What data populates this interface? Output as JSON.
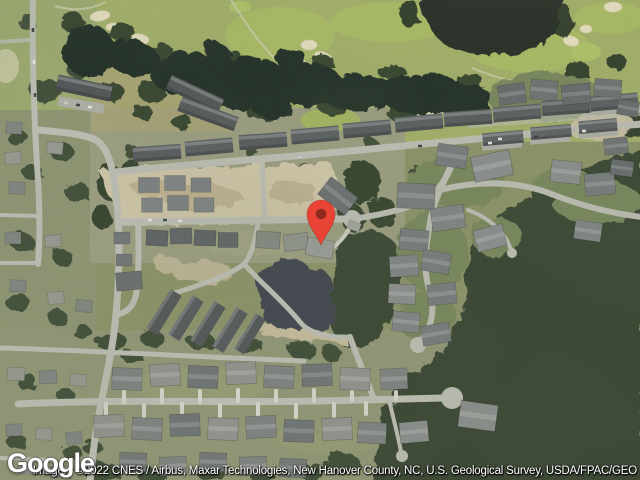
{
  "branding": {
    "logo_text": "Google"
  },
  "attribution": {
    "text": "Imagery ©2022 CNES / Airbus, Maxar Technologies, New Hanover County, NC, U.S. Geological Survey, USDA/FPAC/GEO"
  },
  "map": {
    "marker": {
      "color": "#E94336",
      "dot_color": "#8E2A1E"
    }
  }
}
